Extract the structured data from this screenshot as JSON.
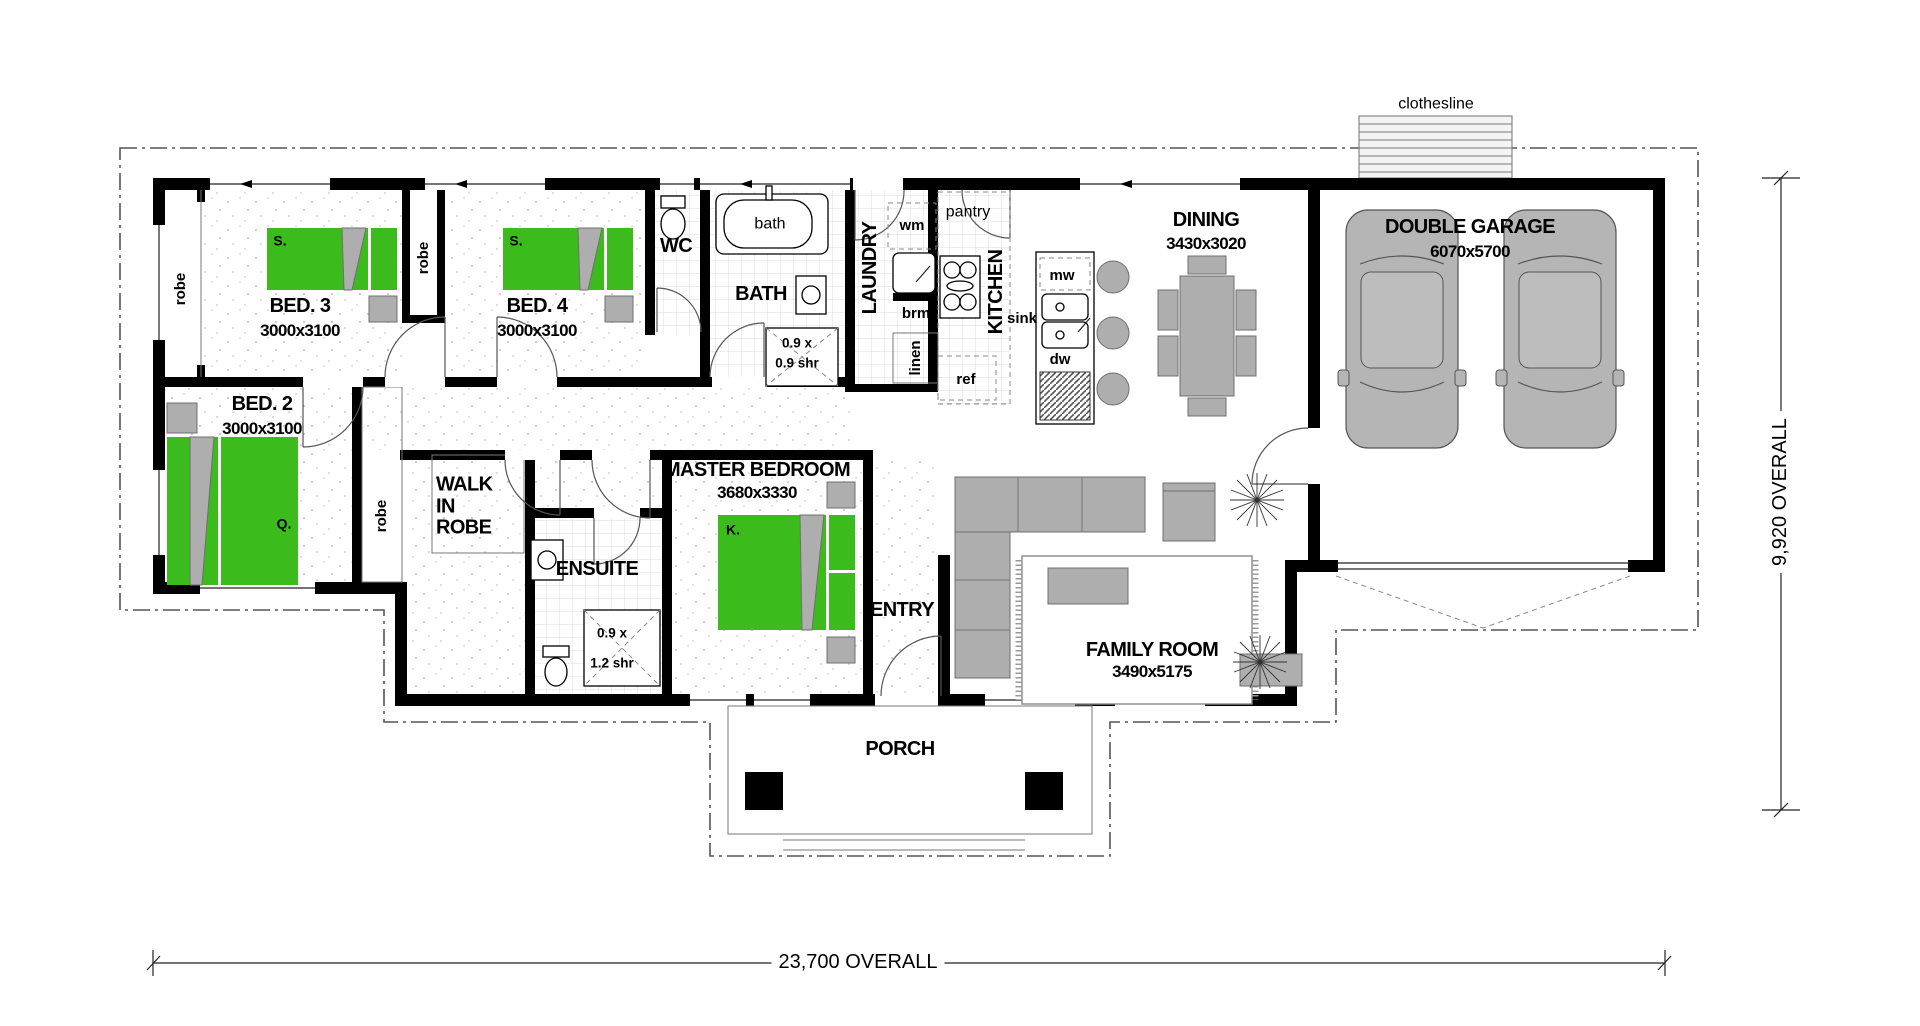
{
  "rooms": {
    "bed3": {
      "name": "BED. 3",
      "dims": "3000x3100"
    },
    "bed4": {
      "name": "BED. 4",
      "dims": "3000x3100"
    },
    "bed2": {
      "name": "BED. 2",
      "dims": "3000x3100"
    },
    "master": {
      "name": "MASTER BEDROOM",
      "dims": "3680x3330"
    },
    "walk_in_robe": {
      "name": "WALK IN ROBE"
    },
    "ensuite": {
      "name": "ENSUITE"
    },
    "wc": {
      "name": "WC"
    },
    "bath": {
      "name": "BATH"
    },
    "laundry": {
      "name": "LAUNDRY"
    },
    "kitchen": {
      "name": "KITCHEN"
    },
    "dining": {
      "name": "DINING",
      "dims": "3430x3020"
    },
    "family": {
      "name": "FAMILY ROOM",
      "dims": "3490x5175"
    },
    "garage": {
      "name": "DOUBLE GARAGE",
      "dims": "6070x5700"
    },
    "entry": {
      "name": "ENTRY"
    },
    "porch": {
      "name": "PORCH"
    }
  },
  "fixtures": {
    "bath_tub": "bath",
    "washing_machine": "wm",
    "broom_cupboard": "brm",
    "linen": "linen",
    "pantry": "pantry",
    "fridge": "ref",
    "microwave": "mw",
    "sink": "sink",
    "dishwasher": "dw",
    "robe": "robe",
    "clothesline": "clothesline",
    "shower_bath": {
      "line1": "0.9 x",
      "line2": "0.9 shr"
    },
    "shower_ensuite": {
      "line1": "0.9 x",
      "line2": "1.2 shr"
    },
    "single_bed": "S.",
    "queen_bed": "Q.",
    "king_bed": "K."
  },
  "dimensions": {
    "width": "23,700 OVERALL",
    "height": "9,920 OVERALL"
  },
  "colors": {
    "bed_green": "#3cbb1d",
    "furniture_gray": "#aeaeae",
    "wall": "#000000"
  }
}
